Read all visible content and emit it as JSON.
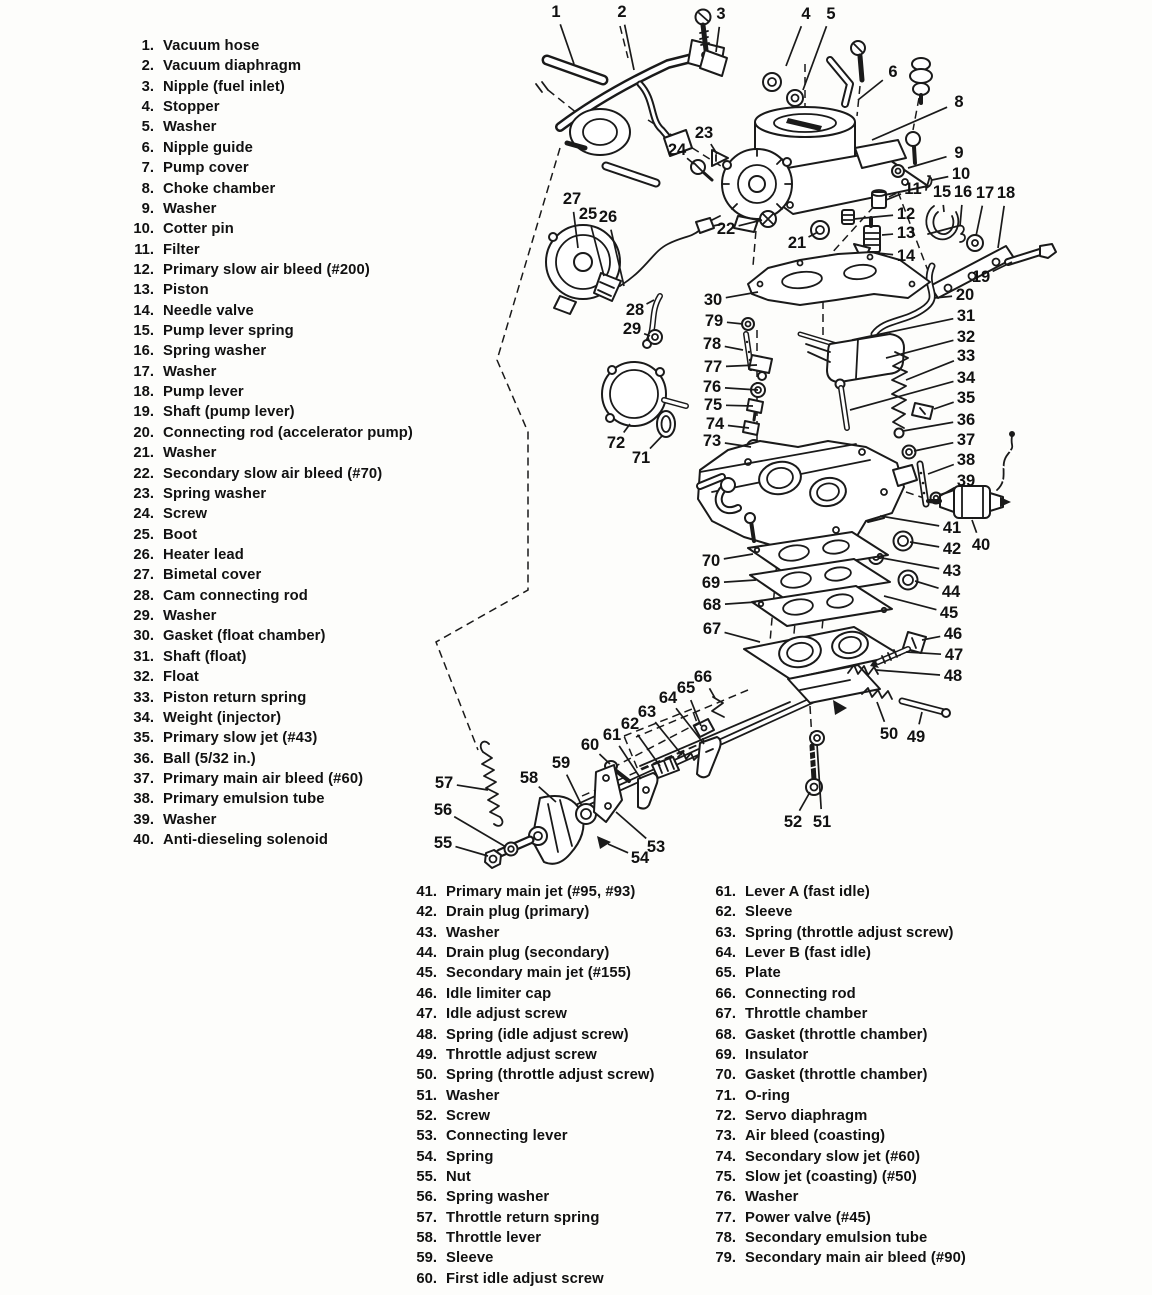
{
  "document": {
    "kind": "carburetor exploded parts diagram",
    "ink_color": "#1a1a1a",
    "paper_color": "#fdfdfb"
  },
  "parts_list_left": [
    {
      "n": "1.",
      "t": "Vacuum hose"
    },
    {
      "n": "2.",
      "t": "Vacuum diaphragm"
    },
    {
      "n": "3.",
      "t": "Nipple (fuel inlet)"
    },
    {
      "n": "4.",
      "t": "Stopper"
    },
    {
      "n": "5.",
      "t": "Washer"
    },
    {
      "n": "6.",
      "t": "Nipple guide"
    },
    {
      "n": "7.",
      "t": "Pump cover"
    },
    {
      "n": "8.",
      "t": "Choke chamber"
    },
    {
      "n": "9.",
      "t": "Washer"
    },
    {
      "n": "10.",
      "t": "Cotter pin"
    },
    {
      "n": "11.",
      "t": "Filter"
    },
    {
      "n": "12.",
      "t": "Primary slow air bleed (#200)"
    },
    {
      "n": "13.",
      "t": "Piston"
    },
    {
      "n": "14.",
      "t": "Needle valve"
    },
    {
      "n": "15.",
      "t": "Pump lever spring"
    },
    {
      "n": "16.",
      "t": "Spring washer"
    },
    {
      "n": "17.",
      "t": "Washer"
    },
    {
      "n": "18.",
      "t": "Pump lever"
    },
    {
      "n": "19.",
      "t": "Shaft (pump lever)"
    },
    {
      "n": "20.",
      "t": "Connecting rod (accelerator pump)"
    },
    {
      "n": "21.",
      "t": "Washer"
    },
    {
      "n": "22.",
      "t": "Secondary slow air bleed (#70)"
    },
    {
      "n": "23.",
      "t": "Spring washer"
    },
    {
      "n": "24.",
      "t": "Screw"
    },
    {
      "n": "25.",
      "t": "Boot"
    },
    {
      "n": "26.",
      "t": "Heater lead"
    },
    {
      "n": "27.",
      "t": "Bimetal cover"
    },
    {
      "n": "28.",
      "t": "Cam connecting rod"
    },
    {
      "n": "29.",
      "t": "Washer"
    },
    {
      "n": "30.",
      "t": "Gasket (float chamber)"
    },
    {
      "n": "31.",
      "t": "Shaft (float)"
    },
    {
      "n": "32.",
      "t": "Float"
    },
    {
      "n": "33.",
      "t": "Piston return spring"
    },
    {
      "n": "34.",
      "t": "Weight (injector)"
    },
    {
      "n": "35.",
      "t": "Primary slow jet (#43)"
    },
    {
      "n": "36.",
      "t": "Ball (5/32 in.)"
    },
    {
      "n": "37.",
      "t": "Primary main air bleed (#60)"
    },
    {
      "n": "38.",
      "t": "Primary emulsion tube"
    },
    {
      "n": "39.",
      "t": "Washer"
    },
    {
      "n": "40.",
      "t": "Anti-dieseling solenoid"
    }
  ],
  "parts_list_bottom_left": [
    {
      "n": "41.",
      "t": "Primary main jet (#95, #93)"
    },
    {
      "n": "42.",
      "t": "Drain plug (primary)"
    },
    {
      "n": "43.",
      "t": "Washer"
    },
    {
      "n": "44.",
      "t": "Drain plug (secondary)"
    },
    {
      "n": "45.",
      "t": "Secondary main jet (#155)"
    },
    {
      "n": "46.",
      "t": "Idle limiter cap"
    },
    {
      "n": "47.",
      "t": "Idle adjust screw"
    },
    {
      "n": "48.",
      "t": "Spring (idle adjust screw)"
    },
    {
      "n": "49.",
      "t": "Throttle adjust screw"
    },
    {
      "n": "50.",
      "t": "Spring (throttle adjust screw)"
    },
    {
      "n": "51.",
      "t": "Washer"
    },
    {
      "n": "52.",
      "t": "Screw"
    },
    {
      "n": "53.",
      "t": "Connecting lever"
    },
    {
      "n": "54.",
      "t": "Spring"
    },
    {
      "n": "55.",
      "t": "Nut"
    },
    {
      "n": "56.",
      "t": "Spring washer"
    },
    {
      "n": "57.",
      "t": "Throttle return spring"
    },
    {
      "n": "58.",
      "t": "Throttle lever"
    },
    {
      "n": "59.",
      "t": "Sleeve"
    },
    {
      "n": "60.",
      "t": "First idle adjust screw"
    }
  ],
  "parts_list_bottom_right": [
    {
      "n": "61.",
      "t": "Lever A (fast idle)"
    },
    {
      "n": "62.",
      "t": "Sleeve"
    },
    {
      "n": "63.",
      "t": "Spring (throttle adjust screw)"
    },
    {
      "n": "64.",
      "t": "Lever B (fast idle)"
    },
    {
      "n": "65.",
      "t": "Plate"
    },
    {
      "n": "66.",
      "t": "Connecting rod"
    },
    {
      "n": "67.",
      "t": "Throttle chamber"
    },
    {
      "n": "68.",
      "t": "Gasket (throttle chamber)"
    },
    {
      "n": "69.",
      "t": "Insulator"
    },
    {
      "n": "70.",
      "t": "Gasket (throttle chamber)"
    },
    {
      "n": "71.",
      "t": "O-ring"
    },
    {
      "n": "72.",
      "t": "Servo diaphragm"
    },
    {
      "n": "73.",
      "t": "Air bleed (coasting)"
    },
    {
      "n": "74.",
      "t": "Secondary slow jet (#60)"
    },
    {
      "n": "75.",
      "t": "Slow jet (coasting) (#50)"
    },
    {
      "n": "76.",
      "t": "Washer"
    },
    {
      "n": "77.",
      "t": "Power valve (#45)"
    },
    {
      "n": "78.",
      "t": "Secondary emulsion tube"
    },
    {
      "n": "79.",
      "t": "Secondary main air bleed (#90)"
    }
  ],
  "callouts": [
    {
      "n": "1",
      "x": 556,
      "y": 12,
      "tx": 574,
      "ty": 64
    },
    {
      "n": "2",
      "x": 622,
      "y": 12,
      "tx": 634,
      "ty": 70
    },
    {
      "n": "3",
      "x": 721,
      "y": 14,
      "tx": 716,
      "ty": 52
    },
    {
      "n": "4",
      "x": 806,
      "y": 14,
      "tx": 786,
      "ty": 66
    },
    {
      "n": "5",
      "x": 831,
      "y": 14,
      "tx": 803,
      "ty": 90
    },
    {
      "n": "6",
      "x": 893,
      "y": 72,
      "tx": 858,
      "ty": 100
    },
    {
      "n": "8",
      "x": 959,
      "y": 102,
      "tx": 872,
      "ty": 140
    },
    {
      "n": "9",
      "x": 959,
      "y": 153,
      "tx": 908,
      "ty": 168
    },
    {
      "n": "10",
      "x": 961,
      "y": 174,
      "tx": 932,
      "ty": 180
    },
    {
      "n": "11",
      "x": 913,
      "y": 189,
      "tx": 886,
      "ty": 200
    },
    {
      "n": "12",
      "x": 906,
      "y": 214,
      "tx": 854,
      "ty": 219
    },
    {
      "n": "13",
      "x": 906,
      "y": 233,
      "tx": 882,
      "ty": 235
    },
    {
      "n": "14",
      "x": 906,
      "y": 256,
      "tx": 868,
      "ty": 252
    },
    {
      "n": "15",
      "x": 942,
      "y": 192,
      "tx": 944,
      "ty": 212
    },
    {
      "n": "16",
      "x": 963,
      "y": 192,
      "tx": 960,
      "ty": 226
    },
    {
      "n": "17",
      "x": 985,
      "y": 193,
      "tx": 976,
      "ty": 236
    },
    {
      "n": "18",
      "x": 1006,
      "y": 193,
      "tx": 998,
      "ty": 248
    },
    {
      "n": "19",
      "x": 981,
      "y": 277,
      "tx": 1012,
      "ty": 262
    },
    {
      "n": "20",
      "x": 965,
      "y": 295,
      "tx": 934,
      "ty": 298
    },
    {
      "n": "21",
      "x": 797,
      "y": 243,
      "tx": 818,
      "ty": 232
    },
    {
      "n": "22",
      "x": 726,
      "y": 229,
      "tx": 762,
      "ty": 220
    },
    {
      "n": "23",
      "x": 704,
      "y": 133,
      "tx": 717,
      "ty": 154
    },
    {
      "n": "24",
      "x": 677,
      "y": 150,
      "tx": 694,
      "ty": 164
    },
    {
      "n": "25",
      "x": 588,
      "y": 214,
      "tx": 604,
      "ty": 276
    },
    {
      "n": "26",
      "x": 608,
      "y": 217,
      "tx": 624,
      "ty": 286
    },
    {
      "n": "27",
      "x": 572,
      "y": 199,
      "tx": 578,
      "ty": 248
    },
    {
      "n": "28",
      "x": 635,
      "y": 310,
      "tx": 654,
      "ty": 300
    },
    {
      "n": "29",
      "x": 632,
      "y": 329,
      "tx": 650,
      "ty": 336
    },
    {
      "n": "30",
      "x": 713,
      "y": 300,
      "tx": 758,
      "ty": 292
    },
    {
      "n": "31",
      "x": 966,
      "y": 316,
      "tx": 852,
      "ty": 340
    },
    {
      "n": "32",
      "x": 966,
      "y": 337,
      "tx": 886,
      "ty": 358
    },
    {
      "n": "33",
      "x": 966,
      "y": 356,
      "tx": 906,
      "ty": 380
    },
    {
      "n": "34",
      "x": 966,
      "y": 378,
      "tx": 850,
      "ty": 410
    },
    {
      "n": "35",
      "x": 966,
      "y": 398,
      "tx": 934,
      "ty": 409
    },
    {
      "n": "36",
      "x": 966,
      "y": 420,
      "tx": 903,
      "ty": 431
    },
    {
      "n": "37",
      "x": 966,
      "y": 440,
      "tx": 914,
      "ty": 451
    },
    {
      "n": "38",
      "x": 966,
      "y": 460,
      "tx": 928,
      "ty": 474
    },
    {
      "n": "39",
      "x": 966,
      "y": 481,
      "tx": 940,
      "ty": 496
    },
    {
      "n": "40",
      "x": 981,
      "y": 545,
      "tx": 972,
      "ty": 520
    },
    {
      "n": "41",
      "x": 952,
      "y": 528,
      "tx": 880,
      "ty": 516
    },
    {
      "n": "42",
      "x": 952,
      "y": 549,
      "tx": 910,
      "ty": 542
    },
    {
      "n": "43",
      "x": 952,
      "y": 571,
      "tx": 882,
      "ty": 558
    },
    {
      "n": "44",
      "x": 951,
      "y": 592,
      "tx": 915,
      "ty": 581
    },
    {
      "n": "45",
      "x": 949,
      "y": 613,
      "tx": 884,
      "ty": 596
    },
    {
      "n": "46",
      "x": 953,
      "y": 634,
      "tx": 922,
      "ty": 640
    },
    {
      "n": "47",
      "x": 954,
      "y": 655,
      "tx": 906,
      "ty": 652
    },
    {
      "n": "48",
      "x": 953,
      "y": 676,
      "tx": 876,
      "ty": 670
    },
    {
      "n": "49",
      "x": 916,
      "y": 737,
      "tx": 922,
      "ty": 712
    },
    {
      "n": "50",
      "x": 889,
      "y": 734,
      "tx": 877,
      "ty": 702
    },
    {
      "n": "51",
      "x": 822,
      "y": 822,
      "tx": 817,
      "ty": 744
    },
    {
      "n": "52",
      "x": 793,
      "y": 822,
      "tx": 810,
      "ty": 792
    },
    {
      "n": "53",
      "x": 656,
      "y": 847,
      "tx": 616,
      "ty": 812
    },
    {
      "n": "54",
      "x": 640,
      "y": 858,
      "tx": 608,
      "ty": 844
    },
    {
      "n": "55",
      "x": 443,
      "y": 843,
      "tx": 488,
      "ty": 856
    },
    {
      "n": "56",
      "x": 443,
      "y": 810,
      "tx": 506,
      "ty": 847
    },
    {
      "n": "57",
      "x": 444,
      "y": 783,
      "tx": 488,
      "ty": 790
    },
    {
      "n": "58",
      "x": 529,
      "y": 778,
      "tx": 556,
      "ty": 802
    },
    {
      "n": "59",
      "x": 561,
      "y": 763,
      "tx": 582,
      "ty": 806
    },
    {
      "n": "60",
      "x": 590,
      "y": 745,
      "tx": 610,
      "ty": 764
    },
    {
      "n": "61",
      "x": 612,
      "y": 735,
      "tx": 641,
      "ty": 779
    },
    {
      "n": "62",
      "x": 630,
      "y": 724,
      "tx": 660,
      "ty": 766
    },
    {
      "n": "63",
      "x": 647,
      "y": 712,
      "tx": 682,
      "ty": 755
    },
    {
      "n": "64",
      "x": 668,
      "y": 698,
      "tx": 704,
      "ty": 744
    },
    {
      "n": "65",
      "x": 686,
      "y": 688,
      "tx": 701,
      "ty": 726
    },
    {
      "n": "66",
      "x": 703,
      "y": 677,
      "tx": 715,
      "ty": 698
    },
    {
      "n": "67",
      "x": 712,
      "y": 629,
      "tx": 760,
      "ty": 642
    },
    {
      "n": "68",
      "x": 712,
      "y": 605,
      "tx": 756,
      "ty": 602
    },
    {
      "n": "69",
      "x": 711,
      "y": 583,
      "tx": 756,
      "ty": 580
    },
    {
      "n": "70",
      "x": 711,
      "y": 561,
      "tx": 753,
      "ty": 554
    },
    {
      "n": "71",
      "x": 641,
      "y": 458,
      "tx": 662,
      "ty": 436
    },
    {
      "n": "72",
      "x": 616,
      "y": 443,
      "tx": 630,
      "ty": 424
    },
    {
      "n": "73",
      "x": 712,
      "y": 441,
      "tx": 751,
      "ty": 447
    },
    {
      "n": "74",
      "x": 715,
      "y": 424,
      "tx": 749,
      "ty": 428
    },
    {
      "n": "75",
      "x": 713,
      "y": 405,
      "tx": 753,
      "ty": 406
    },
    {
      "n": "76",
      "x": 712,
      "y": 387,
      "tx": 758,
      "ty": 390
    },
    {
      "n": "77",
      "x": 713,
      "y": 367,
      "tx": 757,
      "ty": 365
    },
    {
      "n": "78",
      "x": 712,
      "y": 344,
      "tx": 743,
      "ty": 350
    },
    {
      "n": "79",
      "x": 714,
      "y": 321,
      "tx": 743,
      "ty": 324
    }
  ]
}
